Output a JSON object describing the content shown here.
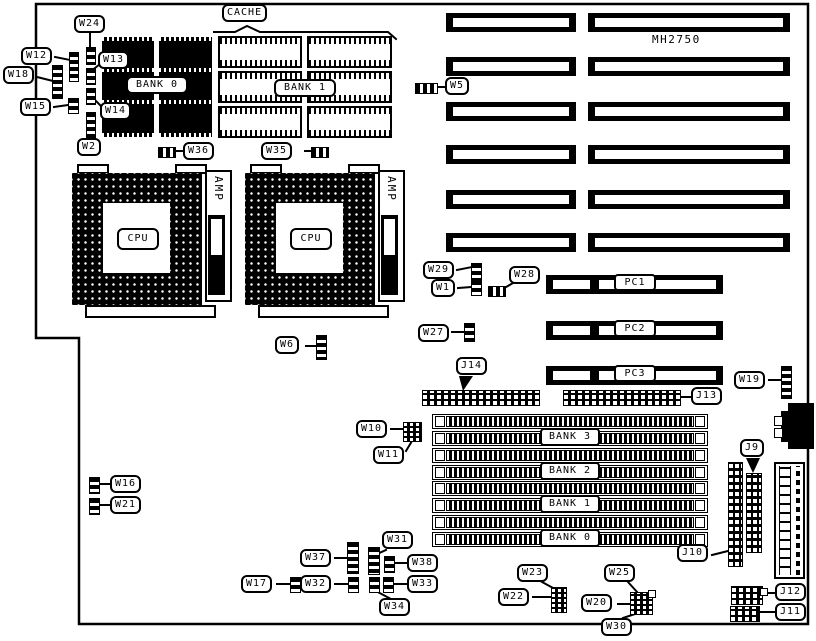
{
  "title": {
    "model": "MH2750"
  },
  "memory": {
    "cache_label": "CACHE",
    "dram_bank": "BANK 0",
    "cache_bank": "BANK 1",
    "simm_banks": [
      "BANK 3",
      "BANK 2",
      "BANK 1",
      "BANK 0"
    ]
  },
  "cpu": {
    "label": "CPU",
    "socket_brand": "AMP"
  },
  "slots": {
    "pc": [
      "PC1",
      "PC2",
      "PC3"
    ]
  },
  "jumpers": {
    "w1": "W1",
    "w2": "W2",
    "w5": "W5",
    "w6": "W6",
    "w10": "W10",
    "w11": "W11",
    "w12": "W12",
    "w13": "W13",
    "w14": "W14",
    "w15": "W15",
    "w16": "W16",
    "w17": "W17",
    "w18": "W18",
    "w19": "W19",
    "w20": "W20",
    "w21": "W21",
    "w22": "W22",
    "w23": "W23",
    "w24": "W24",
    "w25": "W25",
    "w27": "W27",
    "w28": "W28",
    "w29": "W29",
    "w30": "W30",
    "w31": "W31",
    "w32": "W32",
    "w33": "W33",
    "w34": "W34",
    "w35": "W35",
    "w36": "W36",
    "w37": "W37",
    "w38": "W38"
  },
  "connectors": {
    "j9": "J9",
    "j10": "J10",
    "j11": "J11",
    "j12": "J12",
    "j13": "J13",
    "j14": "J14"
  }
}
